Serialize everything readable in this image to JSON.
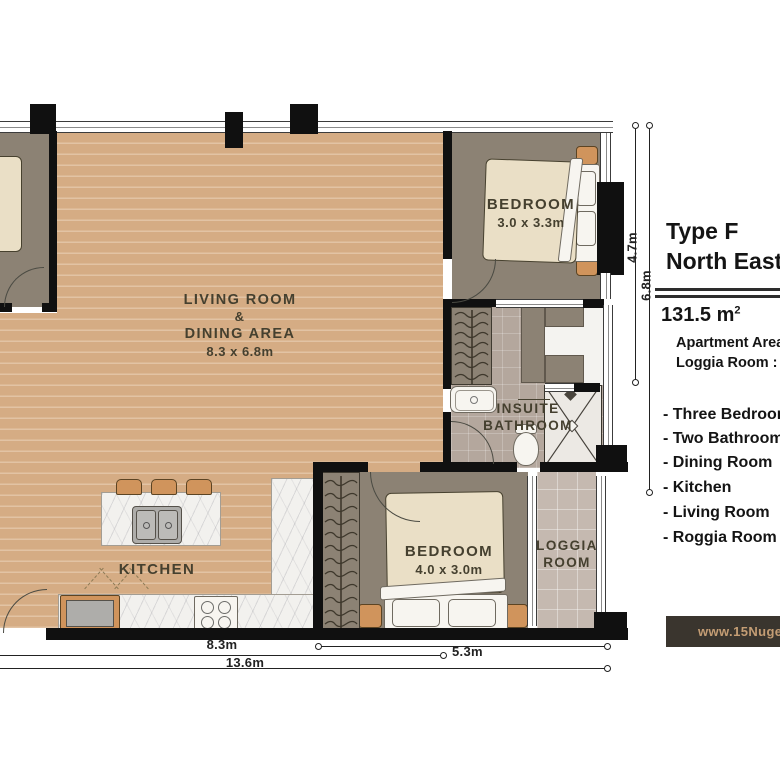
{
  "colors": {
    "wall": "#101010",
    "floor_wood": "#d5ac84",
    "floor_bedroom": "#8c8274",
    "floor_bath": "#b4a79d",
    "floor_loggia": "#c5b9b0",
    "furniture_cream": "#eadfc6",
    "furniture_white": "#f7f5f0",
    "accent_orange": "#d0945c",
    "marble": "#f2f1ee",
    "label": "#45402f",
    "dim": "#222222",
    "panel_text": "#141414",
    "website_bg": "#3a352e",
    "website_text": "#c49d74"
  },
  "plan": {
    "living": {
      "line1": "LIVING ROOM",
      "line2": "&",
      "line3": "DINING AREA",
      "dims": "8.3 x 6.8m"
    },
    "bedroom1": {
      "name": "BEDROOM",
      "dims": "3.0 x 3.3m"
    },
    "bedroom2": {
      "name": "BEDROOM",
      "dims": "4.0 x 3.0m"
    },
    "bathroom": {
      "line1": "INSUITE",
      "line2": "BATHROOM"
    },
    "loggia": {
      "line1": "LOGGIA",
      "line2": "ROOM"
    },
    "kitchen": {
      "name": "KITCHEN"
    },
    "dims": {
      "d83": "8.3m",
      "d53": "5.3m",
      "d136": "13.6m",
      "d47": "4.7m",
      "d68": "6.8m"
    }
  },
  "info_panel": {
    "type_line1": "Type F",
    "type_line2": "North East",
    "area": "131.5 m",
    "area_sup": "2",
    "detail_line1": "Apartment Area :",
    "detail_line2": "Loggia Room :",
    "features": [
      "- Three Bedroom",
      "- Two Bathroom",
      "- Dining Room",
      "- Kitchen",
      "- Living Room",
      "- Roggia Room"
    ],
    "website": "www.15Nugen"
  }
}
